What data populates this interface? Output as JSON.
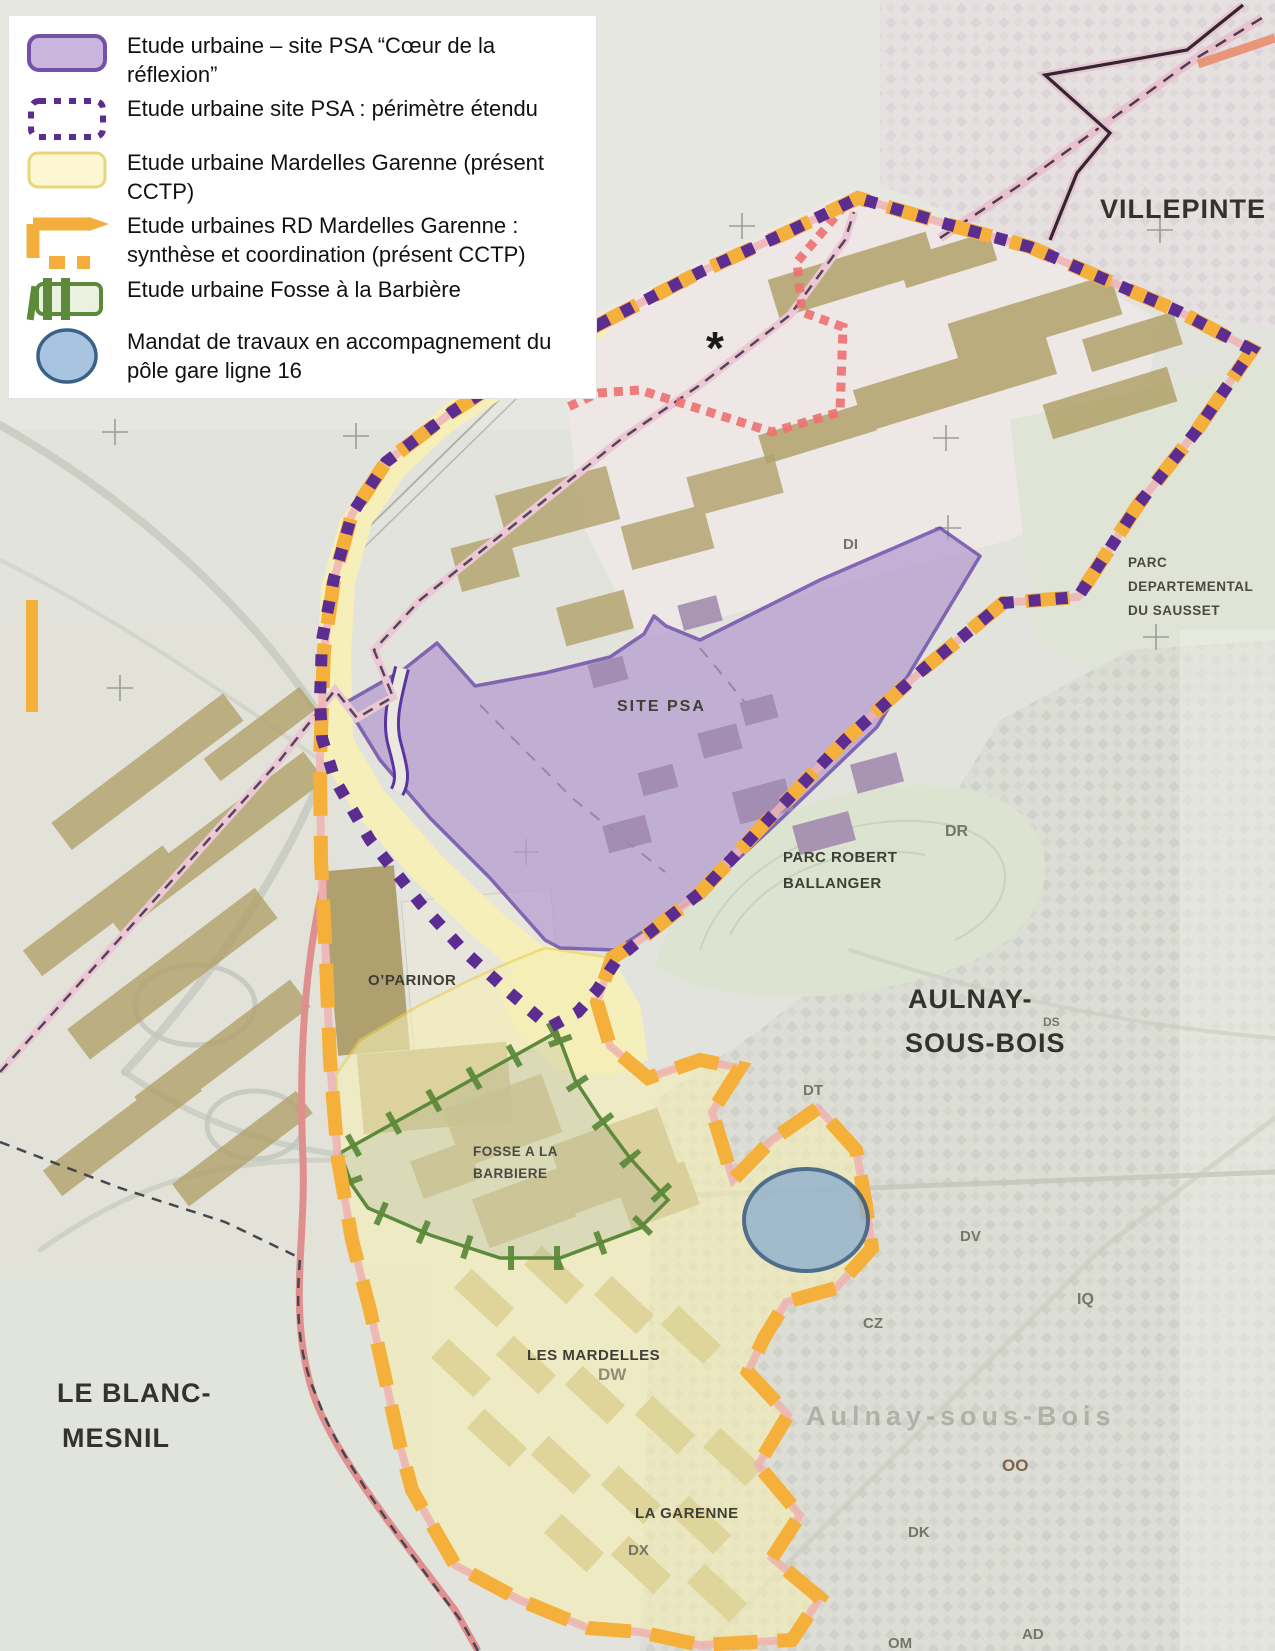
{
  "legend": {
    "items": [
      {
        "id": "psa-core",
        "swatch": "purple-filled-rect",
        "label": "Etude urbaine – site PSA “Cœur de la réflexion”"
      },
      {
        "id": "psa-extended",
        "swatch": "purple-dotted-outline",
        "label": "Etude urbaine site PSA : périmètre étendu"
      },
      {
        "id": "mardelles-garenne",
        "swatch": "pale-yellow-rect",
        "label": "Etude urbaine Mardelles Garenne (présent CCTP)"
      },
      {
        "id": "rd-mardelles-garenne",
        "swatch": "orange-thick-dashes",
        "label": "Etude urbaines RD Mardelles Garenne : synthèse et coordination (présent CCTP)"
      },
      {
        "id": "fosse-barbiere",
        "swatch": "green-ticked-rect",
        "label": "Etude urbaine Fosse à la Barbière"
      },
      {
        "id": "pole-gare",
        "swatch": "blue-ellipse",
        "label": "Mandat de travaux en accompagnement du pôle gare ligne 16"
      }
    ]
  },
  "map": {
    "cities": {
      "villepinte": "VILLEPINTE",
      "aulnay_l1": "AULNAY-",
      "aulnay_l2": "SOUS-BOIS",
      "blanc_mesnil_l1": "LE BLANC-",
      "blanc_mesnil_l2": "MESNIL"
    },
    "areas": {
      "sausset_l1": "PARC",
      "sausset_l2": "DEPARTEMENTAL",
      "sausset_l3": "DU SAUSSET",
      "site_psa": "SITE PSA",
      "ballanger_l1": "PARC ROBERT",
      "ballanger_l2": "BALLANGER",
      "oparinor": "O’PARINOR",
      "fosse_l1": "FOSSE A LA",
      "fosse_l2": "BARBIERE",
      "mardelles": "LES MARDELLES",
      "garenne": "LA GARENNE"
    },
    "road_codes": {
      "di": "DI",
      "dr": "DR",
      "ds": "DS",
      "dt": "DT",
      "dv": "DV",
      "dw": "DW",
      "dx": "DX",
      "cz": "CZ",
      "iq": "IQ",
      "oo": "OO",
      "dk": "DK",
      "om": "OM",
      "ad": "AD"
    },
    "watermark": "Aulnay-sous-Bois",
    "symbols": {
      "asterisk": "*"
    },
    "colors": {
      "psa_core_fill": "#b49bd0",
      "psa_core_border": "#5a35a1",
      "extended_perimeter": "#5b2d91",
      "rd_orange": "#f5b03c",
      "mardelles_fill": "#f5eeb4",
      "mardelles_border": "#e8cf4a",
      "fosse_green": "#5d8a3a",
      "gare_ellipse_fill": "#8fafcf",
      "gare_ellipse_border": "#2a507e",
      "commune_pink": "#efb3b3",
      "stipple_red": "#ee7070"
    }
  }
}
